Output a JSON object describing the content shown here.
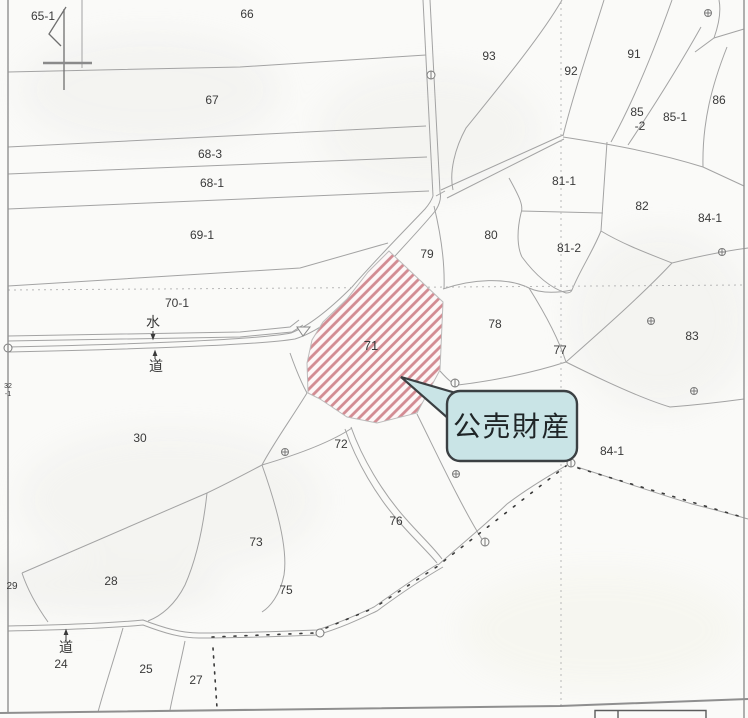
{
  "map": {
    "title_hint": "cadastral parcel map",
    "highlighted_parcel": "71",
    "callout": {
      "text": "公売財産"
    },
    "annotations": {
      "water_label": "水",
      "road_label_middle": "道",
      "road_label_bottom": "道",
      "micro_parcel_line1": "32",
      "micro_parcel_line2": "-1"
    },
    "parcel_labels": [
      {
        "t": "65-1",
        "x": 43,
        "y": 20,
        "s": 12
      },
      {
        "t": "66",
        "x": 247,
        "y": 18,
        "s": 12
      },
      {
        "t": "93",
        "x": 489,
        "y": 60,
        "s": 12
      },
      {
        "t": "92",
        "x": 571,
        "y": 75,
        "s": 12
      },
      {
        "t": "91",
        "x": 634,
        "y": 58,
        "s": 12
      },
      {
        "t": "85",
        "x": 637,
        "y": 116,
        "s": 12
      },
      {
        "t": "-2",
        "x": 640,
        "y": 130,
        "s": 12
      },
      {
        "t": "85-1",
        "x": 675,
        "y": 121,
        "s": 12
      },
      {
        "t": "86",
        "x": 719,
        "y": 104,
        "s": 12
      },
      {
        "t": "67",
        "x": 212,
        "y": 104,
        "s": 12
      },
      {
        "t": "68-3",
        "x": 210,
        "y": 158,
        "s": 12
      },
      {
        "t": "68-1",
        "x": 212,
        "y": 187,
        "s": 12
      },
      {
        "t": "81-1",
        "x": 564,
        "y": 185,
        "s": 12
      },
      {
        "t": "82",
        "x": 642,
        "y": 210,
        "s": 12
      },
      {
        "t": "84-1",
        "x": 710,
        "y": 222,
        "s": 12
      },
      {
        "t": "69-1",
        "x": 202,
        "y": 239,
        "s": 12
      },
      {
        "t": "80",
        "x": 491,
        "y": 239,
        "s": 12
      },
      {
        "t": "79",
        "x": 427,
        "y": 258,
        "s": 12
      },
      {
        "t": "81-2",
        "x": 569,
        "y": 252,
        "s": 12
      },
      {
        "t": "70-1",
        "x": 177,
        "y": 307,
        "s": 12
      },
      {
        "t": "78",
        "x": 495,
        "y": 328,
        "s": 12
      },
      {
        "t": "77",
        "x": 560,
        "y": 354,
        "s": 12
      },
      {
        "t": "83",
        "x": 692,
        "y": 340,
        "s": 12
      },
      {
        "t": "71",
        "x": 371,
        "y": 350,
        "s": 13,
        "c": "#5a5a5a"
      },
      {
        "t": "30",
        "x": 140,
        "y": 442,
        "s": 12
      },
      {
        "t": "72",
        "x": 341,
        "y": 448,
        "s": 12
      },
      {
        "t": "84-1",
        "x": 612,
        "y": 455,
        "s": 12
      },
      {
        "t": "76",
        "x": 396,
        "y": 525,
        "s": 12
      },
      {
        "t": "73",
        "x": 256,
        "y": 546,
        "s": 12
      },
      {
        "t": "28",
        "x": 111,
        "y": 585,
        "s": 12
      },
      {
        "t": "29",
        "x": 12,
        "y": 589,
        "s": 10
      },
      {
        "t": "75",
        "x": 286,
        "y": 594,
        "s": 12
      },
      {
        "t": "24",
        "x": 61,
        "y": 668,
        "s": 12
      },
      {
        "t": "25",
        "x": 146,
        "y": 673,
        "s": 12
      },
      {
        "t": "27",
        "x": 196,
        "y": 684,
        "s": 12
      },
      {
        "t": "32",
        "x": 8,
        "y": 388,
        "s": 7
      },
      {
        "t": "-1",
        "x": 8,
        "y": 396,
        "s": 7
      },
      {
        "t": "水",
        "x": 153,
        "y": 327,
        "s": 14
      },
      {
        "t": "道",
        "x": 156,
        "y": 371,
        "s": 14
      },
      {
        "t": "道",
        "x": 66,
        "y": 652,
        "s": 14
      }
    ]
  },
  "colors": {
    "hatch_stripe": "#d28b92",
    "callout_fill": "#c9e4e6",
    "callout_border": "#3b4043",
    "line_gray": "#a3a3a3",
    "text_dark": "#1f2527"
  }
}
